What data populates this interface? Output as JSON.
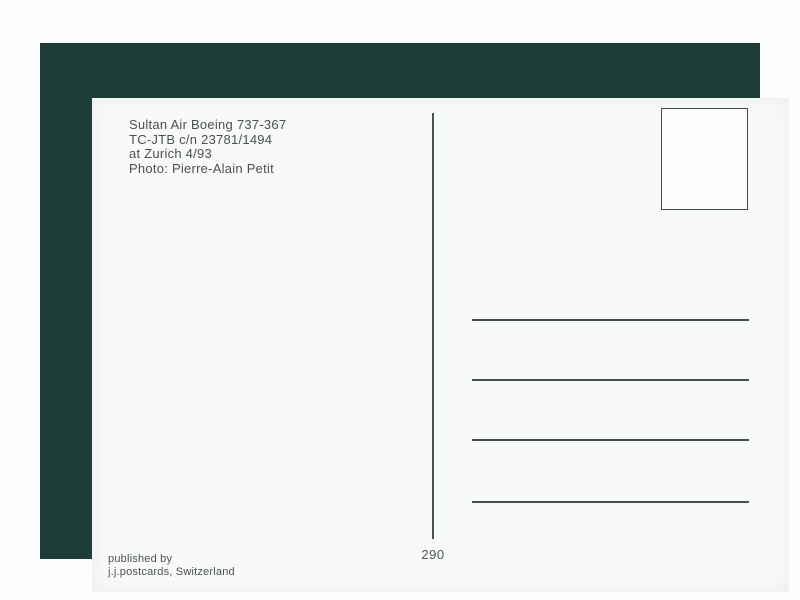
{
  "postcard": {
    "caption": {
      "line1": "Sultan Air Boeing 737-367",
      "line2": "TC-JTB c/n 23781/1494",
      "line3": "at Zurich 4/93",
      "line4": "Photo: Pierre-Alain Petit"
    },
    "card_number": "290",
    "publisher": {
      "line1": "published by",
      "line2": "j.j.postcards, Switzerland"
    },
    "address_lines_count": 4
  },
  "colors": {
    "mat_background": "#1e3c38",
    "card_background": "#f8faf8",
    "ink": "#4b504f",
    "rule_line": "#454e4c"
  }
}
